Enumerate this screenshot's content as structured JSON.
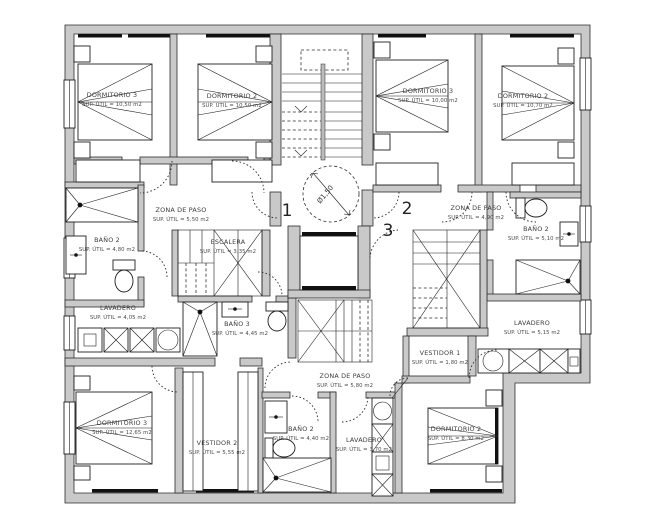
{
  "plan": {
    "turning_circle_label": "Ø1,50",
    "door_numbers": {
      "one": "1",
      "two": "2",
      "three": "3"
    },
    "wall_color": "#c9c9c9",
    "line_color": "#1f1f1f",
    "rooms": [
      {
        "name": "DORMITORIO 3",
        "area": "SUP. ÚTIL = 10,50 m2"
      },
      {
        "name": "DORMITORIO 2",
        "area": "SUP. ÚTIL = 10,50 m2"
      },
      {
        "name": "DORMITORIO 3",
        "area": "SUP. ÚTIL = 10,00 m2"
      },
      {
        "name": "DORMITORIO 2",
        "area": "SUP. ÚTIL = 10,70 m2"
      },
      {
        "name": "ZONA DE PASO",
        "area": "SUP. ÚTIL = 5,50 m2"
      },
      {
        "name": "ESCALERA",
        "area": "SUP. ÚTIL = 3,35 m2"
      },
      {
        "name": "BAÑO 2",
        "area": "SUP. ÚTIL = 4,80 m2"
      },
      {
        "name": "LAVADERO",
        "area": "SUP. ÚTIL = 4,05 m2"
      },
      {
        "name": "BAÑO 3",
        "area": "SUP. ÚTIL = 4,45 m2"
      },
      {
        "name": "ZONA DE PASO",
        "area": "SUP. ÚTIL = 4,90 m2"
      },
      {
        "name": "BAÑO 2",
        "area": "SUP. ÚTIL = 5,10 m2"
      },
      {
        "name": "LAVADERO",
        "area": "SUP. ÚTIL = 5,15 m2"
      },
      {
        "name": "VESTIDOR 1",
        "area": "SUP. ÚTIL = 1,80 m2"
      },
      {
        "name": "ZONA DE PASO",
        "area": "SUP. ÚTIL = 5,80 m2"
      },
      {
        "name": "DORMITORIO 3",
        "area": "SUP. ÚTIL = 12,65 m2"
      },
      {
        "name": "VESTIDOR 2",
        "area": "SUP. ÚTIL = 5,55 m2"
      },
      {
        "name": "BAÑO 2",
        "area": "SUP. ÚTIL = 4,40 m2"
      },
      {
        "name": "LAVADERO",
        "area": "SUP. ÚTIL = 3,70 m2"
      },
      {
        "name": "DORMITORIO 2",
        "area": "SUP. ÚTIL = 8,30 m2"
      }
    ]
  }
}
